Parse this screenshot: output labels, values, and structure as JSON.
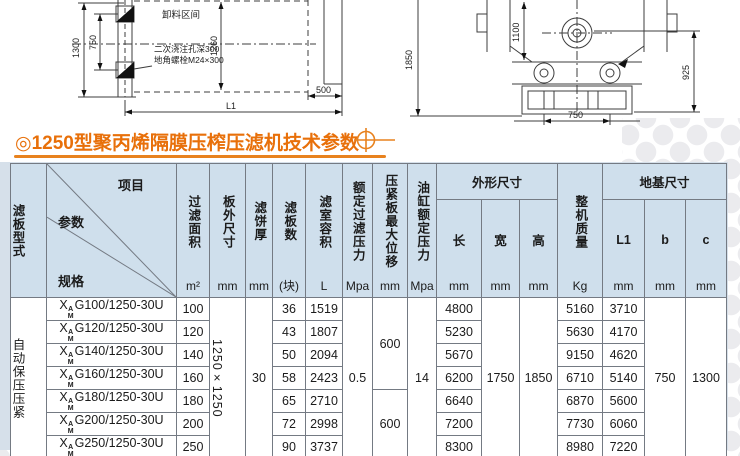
{
  "title": {
    "text": "◎1250型聚丙烯隔膜压榨压滤机技术参数"
  },
  "colors": {
    "accent": "#e8700a",
    "header_bg": "#cfdfec",
    "panel_bg": "#d6e0ea",
    "border": "#747a83"
  },
  "drawing_left": {
    "area_label": "卸料区间",
    "note_line1": "二次浇注孔深300",
    "note_line2": "地角螺栓M24×300",
    "dim_height": "1300",
    "dim_bolt_spacing": "750",
    "dim_inner": "1260",
    "dim_500": "500",
    "dim_l1": "L1"
  },
  "drawing_right": {
    "dim_height": "1850",
    "dim_1100": "1100",
    "dim_925": "925",
    "dim_750": "750"
  },
  "table": {
    "corner": {
      "item": "项目",
      "param": "参数",
      "spec": "规格"
    },
    "headers": {
      "plate_type": "滤板型式",
      "filter_area": {
        "label": "过滤面积",
        "unit": "m²"
      },
      "plate_outer": {
        "label": "板外尺寸",
        "unit": "mm"
      },
      "cake_thickness": {
        "label": "滤饼厚",
        "unit": "mm"
      },
      "plate_count": {
        "label": "滤板数",
        "unit": "(块)"
      },
      "chamber_volume": {
        "label": "滤室容积",
        "unit": "L"
      },
      "filter_pressure": {
        "label": "额定过滤压力",
        "unit": "Mpa"
      },
      "plate_displacement": {
        "label": "压紧板最大位移",
        "unit": "mm"
      },
      "cylinder_pressure": {
        "label": "油缸额定压力",
        "unit": "Mpa"
      },
      "overall_dims": {
        "label": "外形尺寸",
        "unit": "mm",
        "sub": {
          "length": "长",
          "width": "宽",
          "height": "高"
        }
      },
      "machine_weight": {
        "label": "整机质量",
        "unit": "Kg"
      },
      "foundation": {
        "label": "地基尺寸",
        "unit": "mm",
        "sub": {
          "l1": "L1",
          "b": "b",
          "c": "c"
        }
      }
    },
    "row_group": "自动保压压紧",
    "model_prefix": {
      "base": "X",
      "sup": "A",
      "sub": "M"
    },
    "merged": {
      "plate_outer": "1250×1250",
      "cake_thickness": "30",
      "filter_pressure": "0.5",
      "displacement_a": "600",
      "displacement_b": "600",
      "cylinder_pressure": "14",
      "width": "1750",
      "height": "1850",
      "b": "750",
      "c": "1300"
    },
    "rows": [
      {
        "model": "G100/1250-30U",
        "area": "100",
        "plates": "36",
        "volume": "1519",
        "length": "4800",
        "weight": "5160",
        "l1": "3710"
      },
      {
        "model": "G120/1250-30U",
        "area": "120",
        "plates": "43",
        "volume": "1807",
        "length": "5230",
        "weight": "5630",
        "l1": "4170"
      },
      {
        "model": "G140/1250-30U",
        "area": "140",
        "plates": "50",
        "volume": "2094",
        "length": "5670",
        "weight": "9150",
        "l1": "4620"
      },
      {
        "model": "G160/1250-30U",
        "area": "160",
        "plates": "58",
        "volume": "2423",
        "length": "6200",
        "weight": "6710",
        "l1": "5140"
      },
      {
        "model": "G180/1250-30U",
        "area": "180",
        "plates": "65",
        "volume": "2710",
        "length": "6640",
        "weight": "6870",
        "l1": "5600"
      },
      {
        "model": "G200/1250-30U",
        "area": "200",
        "plates": "72",
        "volume": "2998",
        "length": "7200",
        "weight": "7730",
        "l1": "6060"
      },
      {
        "model": "G250/1250-30U",
        "area": "250",
        "plates": "90",
        "volume": "3737",
        "length": "8300",
        "weight": "8980",
        "l1": "7220"
      }
    ]
  }
}
